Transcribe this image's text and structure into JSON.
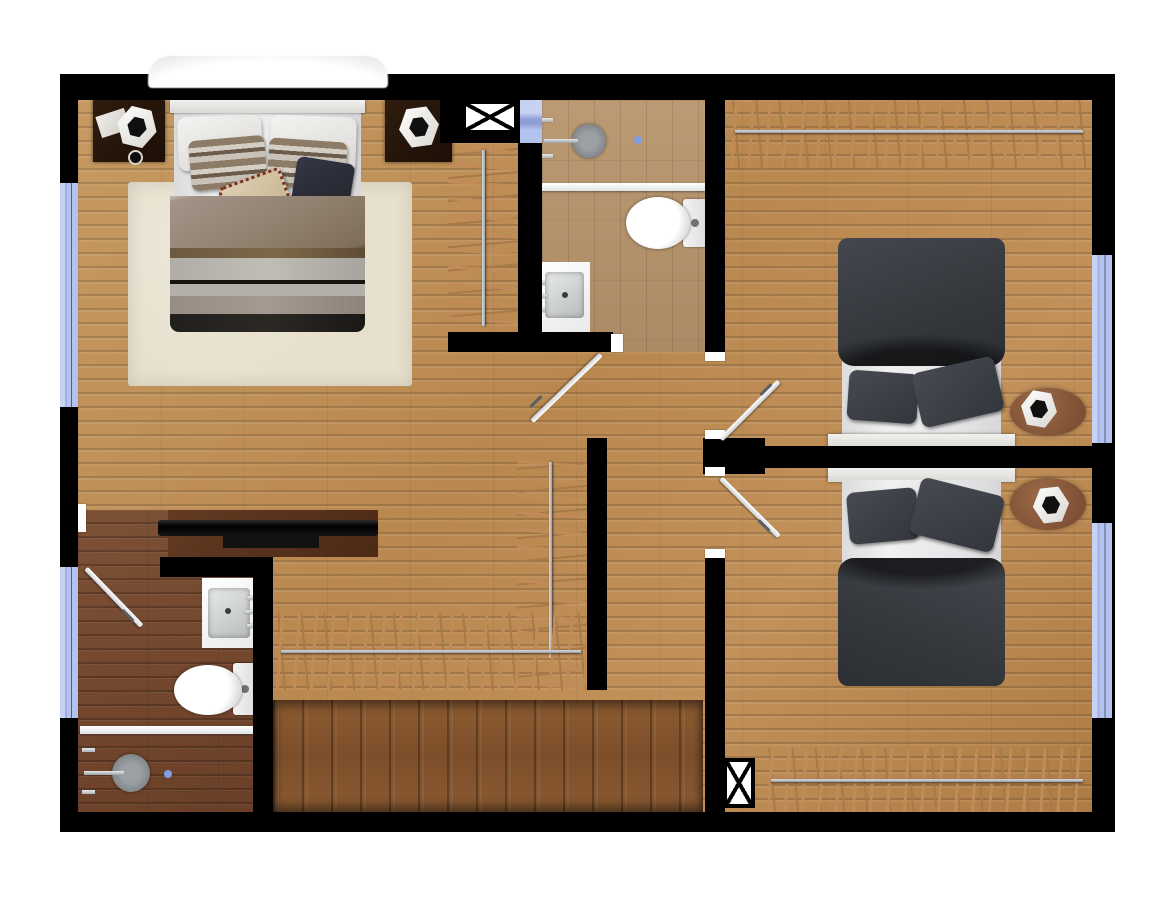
{
  "meta": {
    "kind": "architectural-floor-plan",
    "view": "top-down",
    "visible_text": "none"
  },
  "palette": {
    "wall": "#000000",
    "oak_floor": "#bf8f58",
    "bath_top_floor": "#b3926c",
    "bath_bottom_floor": "#744729",
    "stair_wood": "#86562f",
    "closet_dark": "#241b13",
    "hanger_stick": "#c18b58",
    "rail_metal": "#a9afb6",
    "window_blue": "#aebdec",
    "fixture_white": "#ffffff",
    "duvet_gray": "#3a3d42",
    "rug_cream": "#e7e0cd",
    "console_brown": "#58331f"
  },
  "rooms": [
    {
      "id": "master-bedroom",
      "area": "top-left",
      "furniture": [
        "double-bed",
        "nightstand-left",
        "nightstand-right",
        "hex-lamp-left",
        "hex-lamp-right",
        "area-rug",
        "walk-in-closet-rail"
      ]
    },
    {
      "id": "bathroom-top",
      "area": "top-center",
      "furniture": [
        "walk-in-shower",
        "shower-head",
        "glass-partition",
        "toilet",
        "vanity-sink",
        "floor-drain"
      ]
    },
    {
      "id": "bedroom-2",
      "area": "top-right",
      "furniture": [
        "double-bed",
        "closet-rail-top",
        "oval-side-table",
        "hex-lamp"
      ]
    },
    {
      "id": "bedroom-3",
      "area": "bottom-right",
      "furniture": [
        "double-bed",
        "closet-rail-bottom",
        "oval-side-table",
        "hex-lamp"
      ]
    },
    {
      "id": "bathroom-bottom",
      "area": "bottom-left",
      "furniture": [
        "walk-in-shower",
        "shower-head",
        "glass-partition",
        "toilet",
        "vanity-sink",
        "floor-drain"
      ]
    },
    {
      "id": "hall-landing",
      "area": "center",
      "furniture": [
        "tv-console",
        "flat-tv",
        "l-shaped-closet-rail"
      ]
    },
    {
      "id": "staircase",
      "area": "bottom-center",
      "furniture": [
        "stair-treads"
      ]
    }
  ],
  "openings": {
    "windows": [
      "left-master",
      "left-bathroom",
      "right-bedroom-2",
      "right-bedroom-3",
      "top-small"
    ],
    "doors": [
      "bathroom-top-door",
      "bedroom-2-door",
      "bedroom-3-door",
      "bathroom-bottom-door"
    ],
    "shafts": [
      "x-shaft-top",
      "x-shaft-bottom"
    ]
  }
}
